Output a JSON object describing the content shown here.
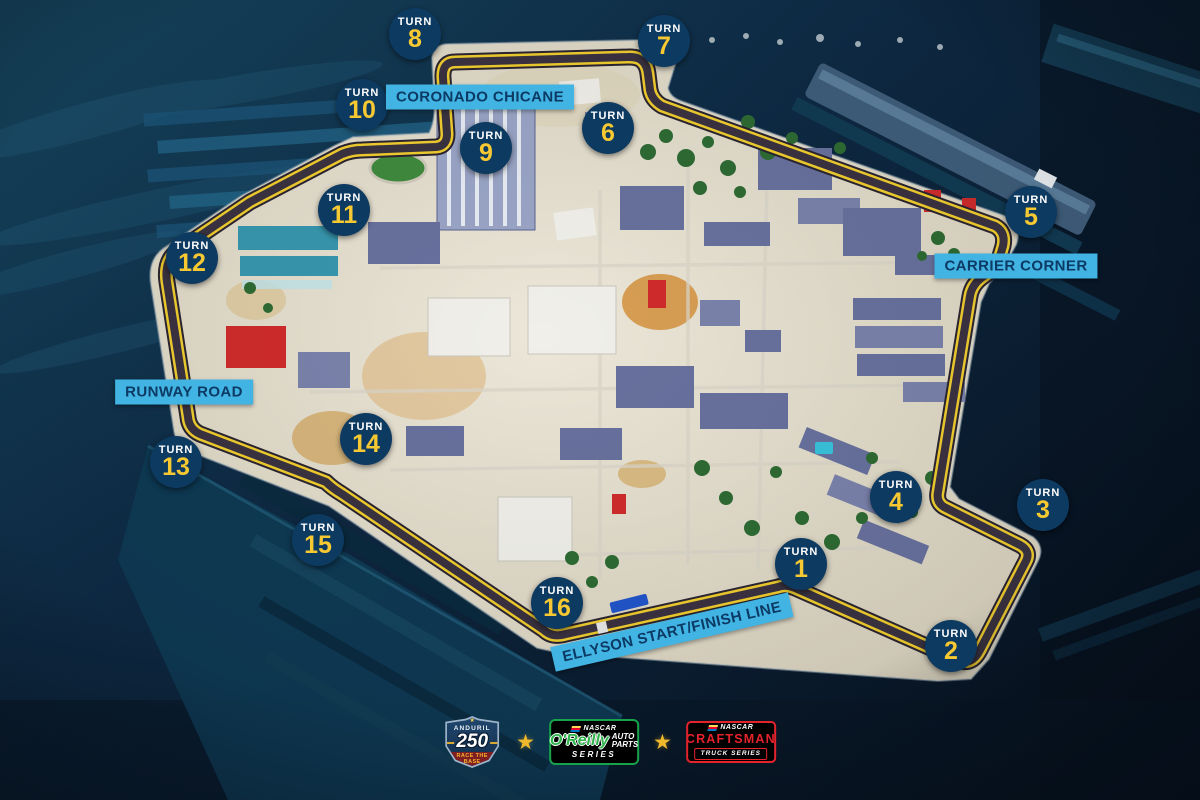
{
  "track": {
    "turn_word": "TURN",
    "turns": [
      {
        "number": "1",
        "x": 801,
        "y": 564
      },
      {
        "number": "2",
        "x": 951,
        "y": 646
      },
      {
        "number": "3",
        "x": 1043,
        "y": 505
      },
      {
        "number": "4",
        "x": 896,
        "y": 497
      },
      {
        "number": "5",
        "x": 1031,
        "y": 212
      },
      {
        "number": "6",
        "x": 608,
        "y": 128
      },
      {
        "number": "7",
        "x": 664,
        "y": 41
      },
      {
        "number": "8",
        "x": 415,
        "y": 34
      },
      {
        "number": "9",
        "x": 486,
        "y": 148
      },
      {
        "number": "10",
        "x": 362,
        "y": 105
      },
      {
        "number": "11",
        "x": 344,
        "y": 210
      },
      {
        "number": "12",
        "x": 192,
        "y": 258
      },
      {
        "number": "13",
        "x": 176,
        "y": 462
      },
      {
        "number": "14",
        "x": 366,
        "y": 439
      },
      {
        "number": "15",
        "x": 318,
        "y": 540
      },
      {
        "number": "16",
        "x": 557,
        "y": 603
      }
    ],
    "map_labels": [
      {
        "id": "coronado-chicane",
        "text": "CORONADO CHICANE",
        "x": 480,
        "y": 97,
        "rotation": 0
      },
      {
        "id": "carrier-corner",
        "text": "CARRIER CORNER",
        "x": 1016,
        "y": 266,
        "rotation": 0
      },
      {
        "id": "runway-road",
        "text": "RUNWAY ROAD",
        "x": 184,
        "y": 392,
        "rotation": 0
      },
      {
        "id": "ellyson-start-finish",
        "text": "ELLYSON START/FINISH LINE",
        "x": 672,
        "y": 632,
        "rotation": -13
      }
    ]
  },
  "footer": {
    "separator": "★",
    "event_logo": {
      "brand": "ANDURIL",
      "number": "250",
      "tagline": "RACE THE BASE"
    },
    "oreilly_logo": {
      "org": "NASCAR",
      "name": "O'Reilly",
      "auto_parts_line1": "AUTO",
      "auto_parts_line2": "PARTS",
      "series": "SERIES"
    },
    "craftsman_logo": {
      "org": "NASCAR",
      "name": "CRAFTSMAN",
      "series": "TRUCK SERIES"
    }
  },
  "colors": {
    "water_deep": "#081523",
    "water_mid": "#0e2a44",
    "water_teal": "#1d5a7c",
    "island_sand": "#e7e1d2",
    "track_asphalt": "#3a3240",
    "track_line_yellow": "#f1cd2e",
    "badge_navy": "#0d3a61",
    "badge_number_yellow": "#f6c832",
    "label_cyan": "#41b4e3",
    "label_text_navy": "#0c3a64",
    "star_gold": "#f0b92d",
    "oreilly_green": "#2fb34a",
    "craftsman_red": "#e4232c"
  }
}
